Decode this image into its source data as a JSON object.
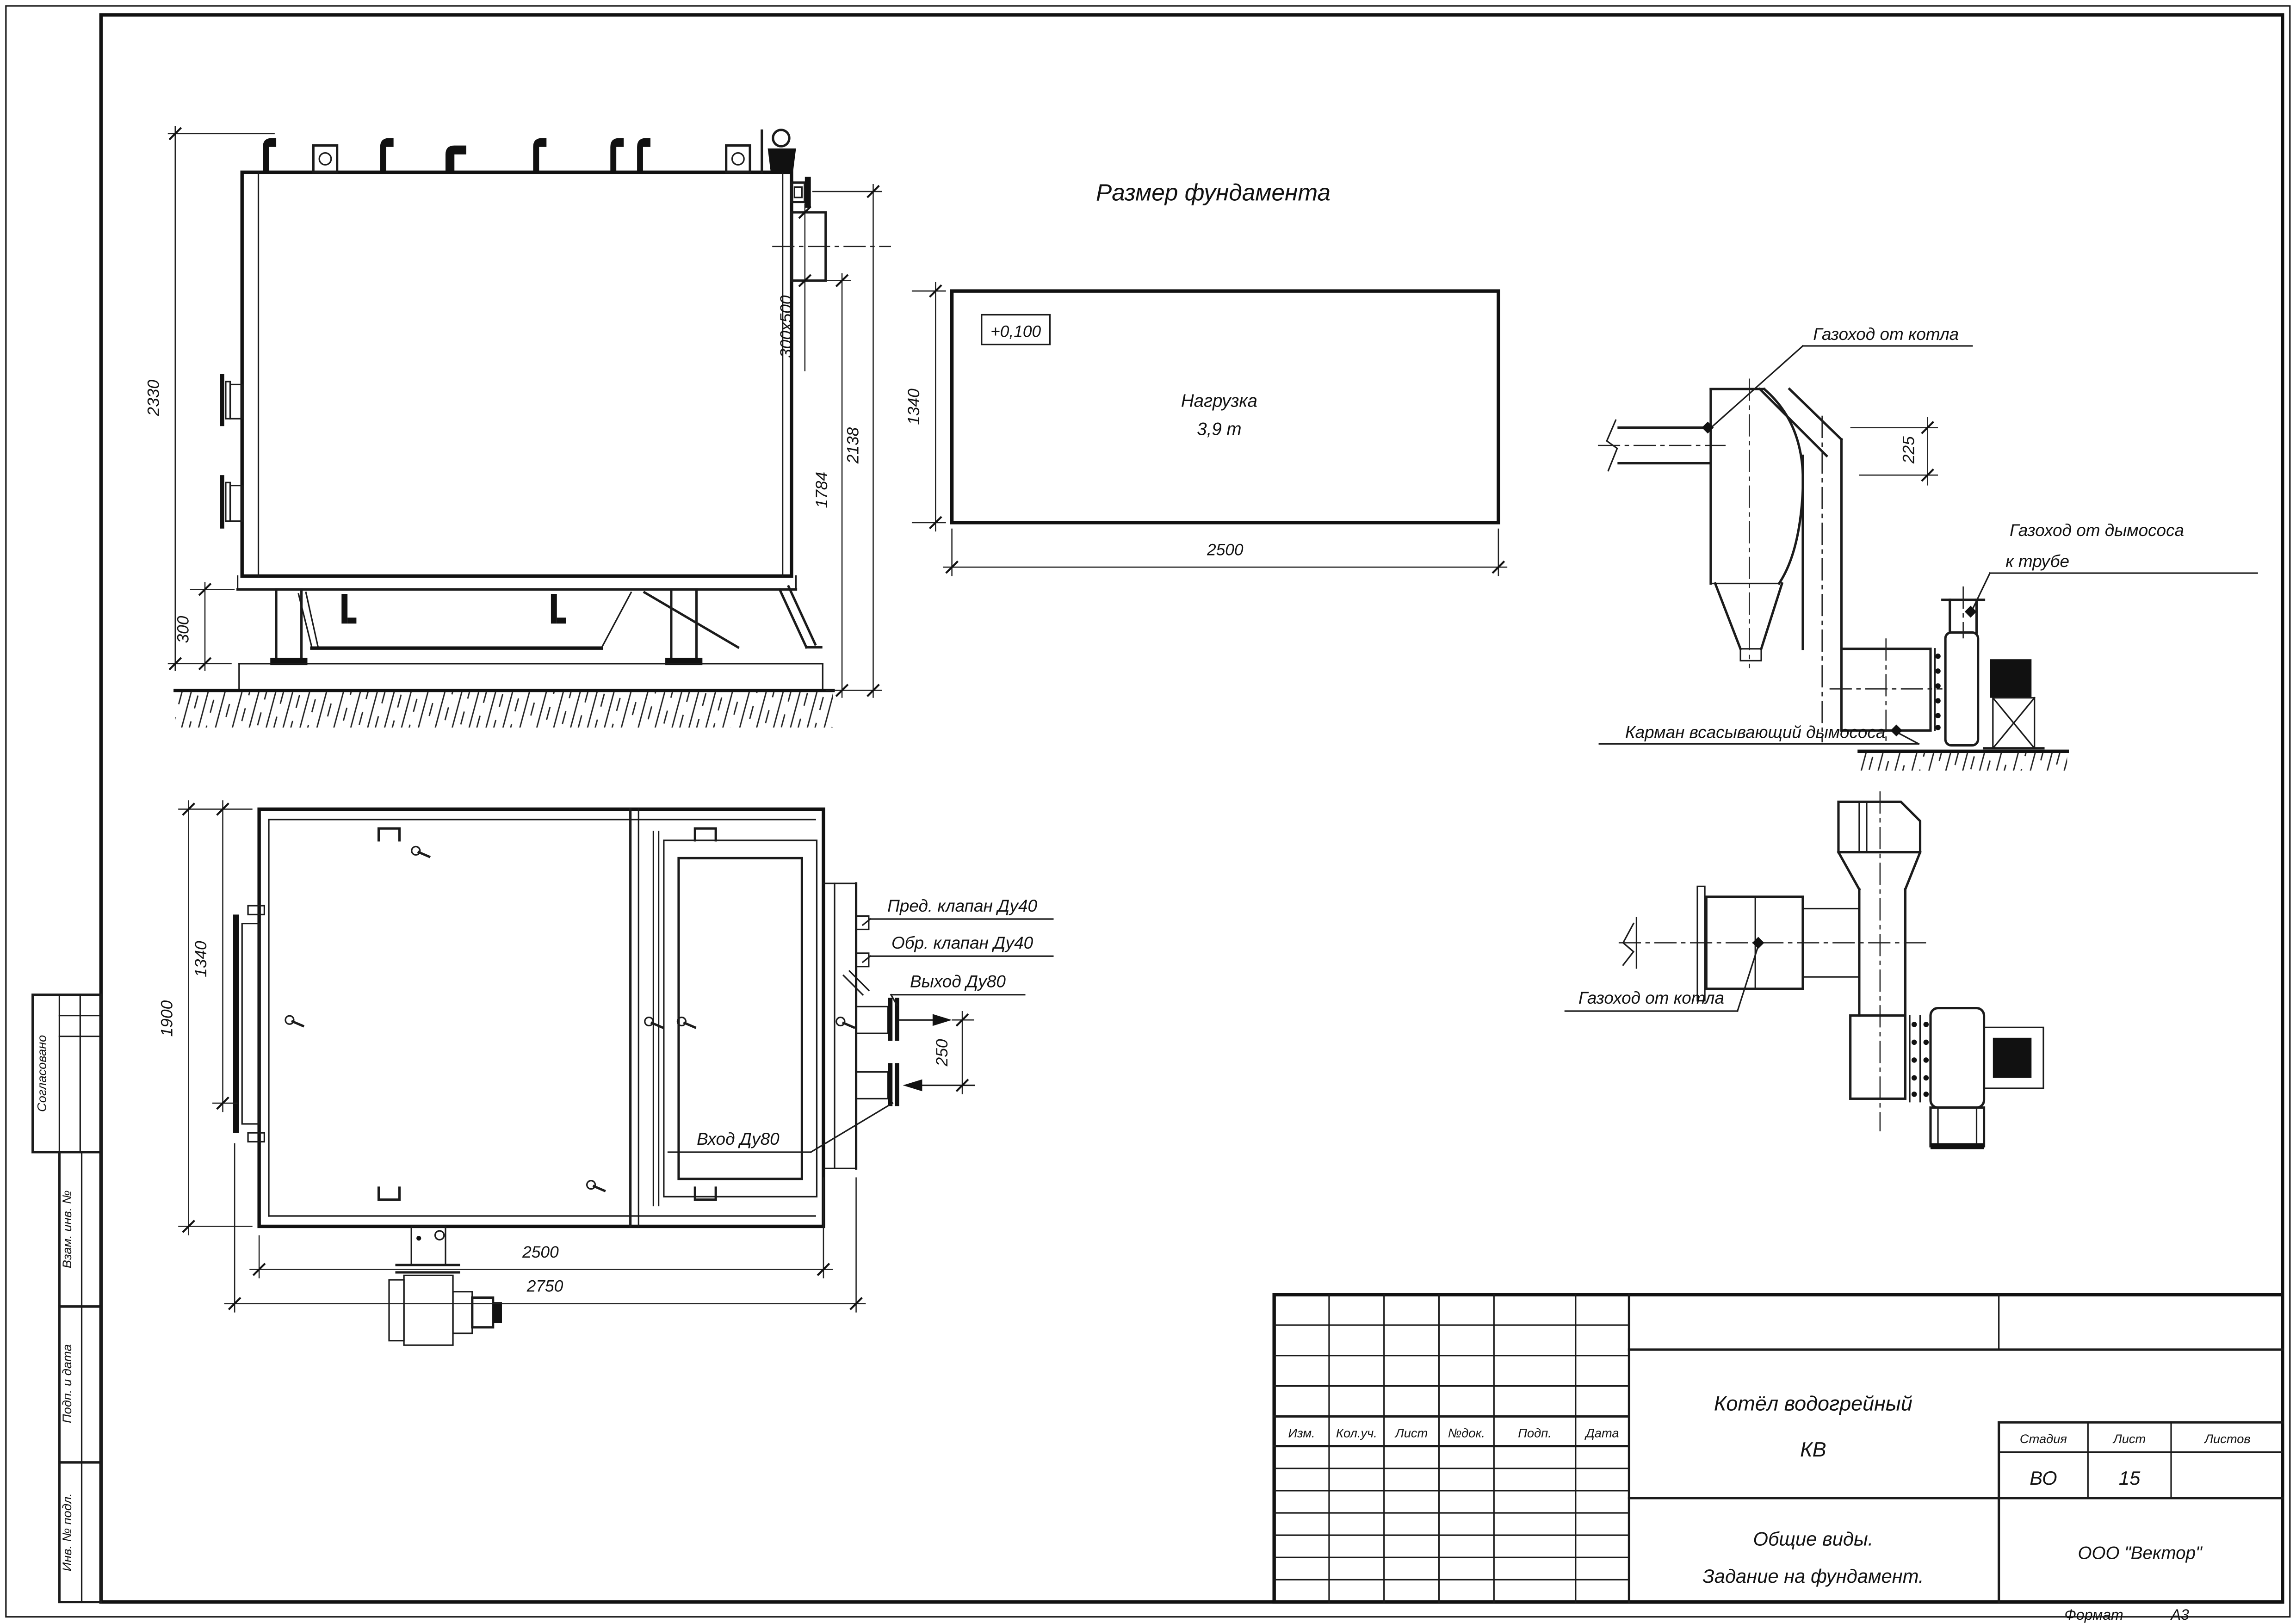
{
  "sheet": {
    "format_label": "Формат",
    "format_value": "А3"
  },
  "margin": {
    "approved": "Согласовано",
    "replace_inv": "Взам. инв. №",
    "sign_date": "Подп. и дата",
    "inv_no": "Инв. № подл."
  },
  "foundation_plan": {
    "title": "Размер фундамента",
    "elevation": "+0,100",
    "load_line1": "Нагрузка",
    "load_line2": "3,9 т",
    "dim_width": "2500",
    "dim_depth": "1340"
  },
  "side_view": {
    "dim_total_height": "2330",
    "dim_foundation": "300",
    "dim_outlet": "300x500",
    "dim_h1": "1784",
    "dim_h2": "2138"
  },
  "plan_view": {
    "dim_width_overall": "1900",
    "dim_width": "1340",
    "dim_length": "2500",
    "dim_length_overall": "2750",
    "dim_pipes": "250",
    "label_safety_valve": "Пред. клапан Ду40",
    "label_check_valve": "Обр. клапан Ду40",
    "label_outlet": "Выход Ду80",
    "label_inlet": "Вход Ду80"
  },
  "flue_side_view": {
    "label_from_boiler": "Газоход от котла",
    "label_to_stack_1": "Газоход от дымососа",
    "label_to_stack_2": "к трубе",
    "label_pocket": "Карман всасывающий дымососа",
    "dim_offset": "225"
  },
  "flue_plan_view": {
    "label_from_boiler": "Газоход от котла"
  },
  "title_block": {
    "rev_headers": [
      "Изм.",
      "Кол.уч.",
      "Лист",
      "№док.",
      "Подп.",
      "Дата"
    ],
    "title_line1": "Котёл водогрейный",
    "title_line2": "КВ",
    "subtitle_line1": "Общие виды.",
    "subtitle_line2": "Задание на фундамент.",
    "stage_label": "Стадия",
    "sheet_label": "Лист",
    "sheets_label": "Листов",
    "stage": "ВО",
    "sheet": "15",
    "sheets": "",
    "company": "ООО \"Вектор\""
  }
}
